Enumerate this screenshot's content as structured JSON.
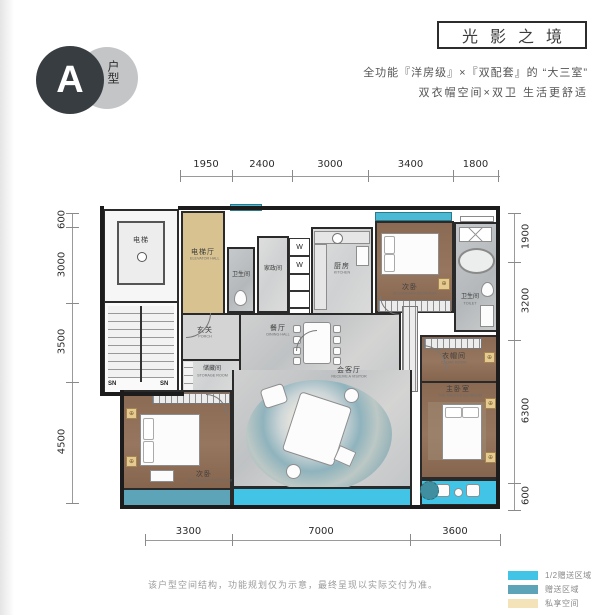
{
  "badge": {
    "letter": "A",
    "label": "户型"
  },
  "title": "光影之境",
  "subtitle_line1": "全功能『洋房级』×『双配套』的 “大三室”",
  "subtitle_line2": "双衣帽空间×双卫 生活更舒适",
  "dimensions": {
    "top": [
      "1950",
      "2400",
      "3000",
      "3400",
      "1800"
    ],
    "bottom": [
      "3300",
      "7000",
      "3600"
    ],
    "left": [
      "600",
      "3000",
      "3500",
      "4500"
    ],
    "right": [
      "1900",
      "3200",
      "6300",
      "600"
    ]
  },
  "rooms": {
    "elevator": {
      "cn": "电梯"
    },
    "elevator_hall": {
      "cn": "电梯厅",
      "en": "ELEVATOR HALL"
    },
    "bath1": {
      "cn": "卫生间"
    },
    "laundry": {
      "cn": "家政间"
    },
    "kitchen": {
      "cn": "厨房",
      "en": "KITCHEN"
    },
    "bedroom2": {
      "cn": "次卧",
      "en": "SECONDARY BEDROOM"
    },
    "bath2": {
      "cn": "卫生间",
      "en": "TOILET"
    },
    "porch": {
      "cn": "玄关",
      "en": "PORCH"
    },
    "storage": {
      "cn": "储藏间",
      "en": "STORAGE ROOM"
    },
    "dining": {
      "cn": "餐厅",
      "en": "DINING HALL"
    },
    "living": {
      "cn": "会客厅",
      "en": "RECEIVE A VISITOR"
    },
    "cloak": {
      "cn": "衣帽间",
      "en": "CLOAK ROOM"
    },
    "master": {
      "cn": "主卧室",
      "en": "THE MASTER BEDROOM"
    },
    "bedroom3": {
      "cn": "次卧",
      "en": "SECONDARY BEDROOM"
    }
  },
  "plan_marks": {
    "sn1": "SN",
    "sn2": "SN",
    "w1": "W",
    "w2": "W",
    "f": "F"
  },
  "disclaimer": "该户型空间结构，功能规划仅为示意，最终呈现以实际交付为准。",
  "legend": [
    {
      "label": "1/2赠送区域",
      "color": "#41c4e5"
    },
    {
      "label": "赠送区域",
      "color": "#5da4b8"
    },
    {
      "label": "私享空间",
      "color": "#f4e3b8"
    }
  ],
  "colors": {
    "accent_cyan": "#41c4e5",
    "accent_teal": "#5da4b8",
    "accent_tan": "#f4e3b8",
    "bay_window": "#49b9d4",
    "hall_tan": "#d8c28f",
    "wall": "#1c1c1c"
  }
}
